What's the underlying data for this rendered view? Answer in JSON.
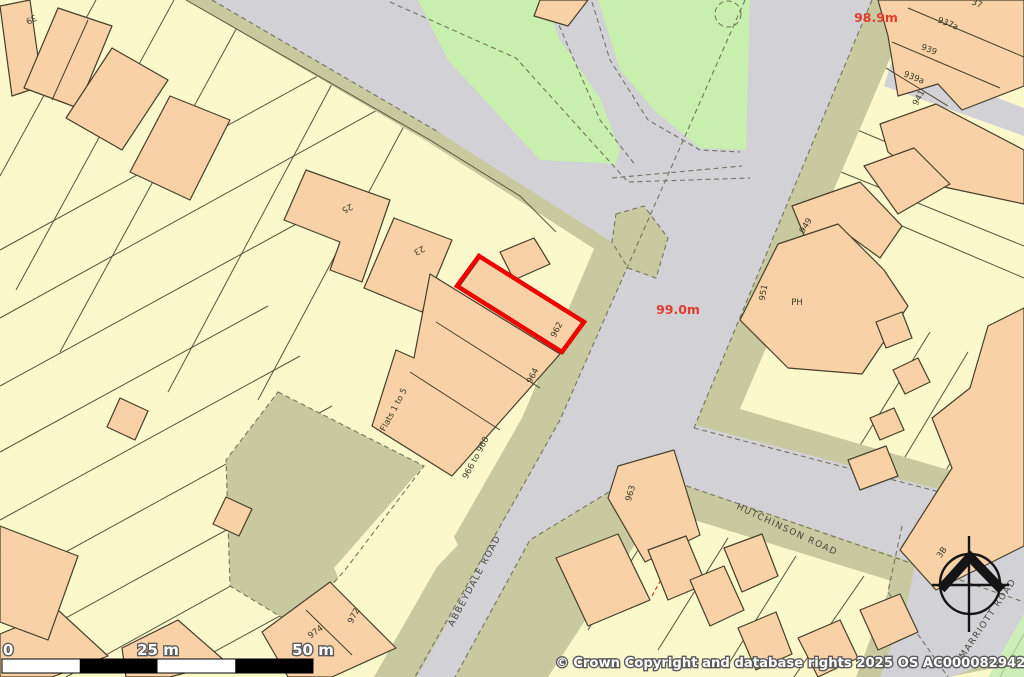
{
  "map": {
    "elevation_labels": {
      "spot_1": "98.9m",
      "spot_2": "99.0m"
    },
    "road_labels": {
      "abbeydale": "ABBEYDALE ROAD",
      "hutchinson": "HUTCHINSON ROAD",
      "marriott": "MARRIOTT ROAD"
    },
    "property_labels": {
      "h39": "39",
      "h25": "25",
      "h23": "23",
      "h962": "962",
      "h964": "964",
      "h966_968": "966 to 968",
      "flats": "Flats 1 to 5",
      "h972": "972",
      "h974": "974",
      "h963": "963",
      "h937": "37",
      "h937a": "937a",
      "h939": "939",
      "h939a": "939a",
      "h941": "941",
      "h949": "949",
      "h951": "951",
      "ph": "PH",
      "h3b": "3B"
    },
    "scale_bar": {
      "start": "0",
      "middle": "25 m",
      "end": "50 m"
    },
    "copyright_notice": "© Crown Copyright and database rights 2025 OS AC0000829429",
    "highlight": {
      "plot": "962",
      "outline_color": "#ee0000"
    },
    "colors": {
      "parcel_cream": "#fbf8cc",
      "building_peach": "#f8d2a6",
      "road_gray": "#d2d1d5",
      "verge_khaki": "#c9c9a0",
      "park_green": "#c8efad",
      "elevation_red": "#e23a2e",
      "highlight_red": "#ee0000",
      "scale_bar_black": "#000000"
    }
  }
}
